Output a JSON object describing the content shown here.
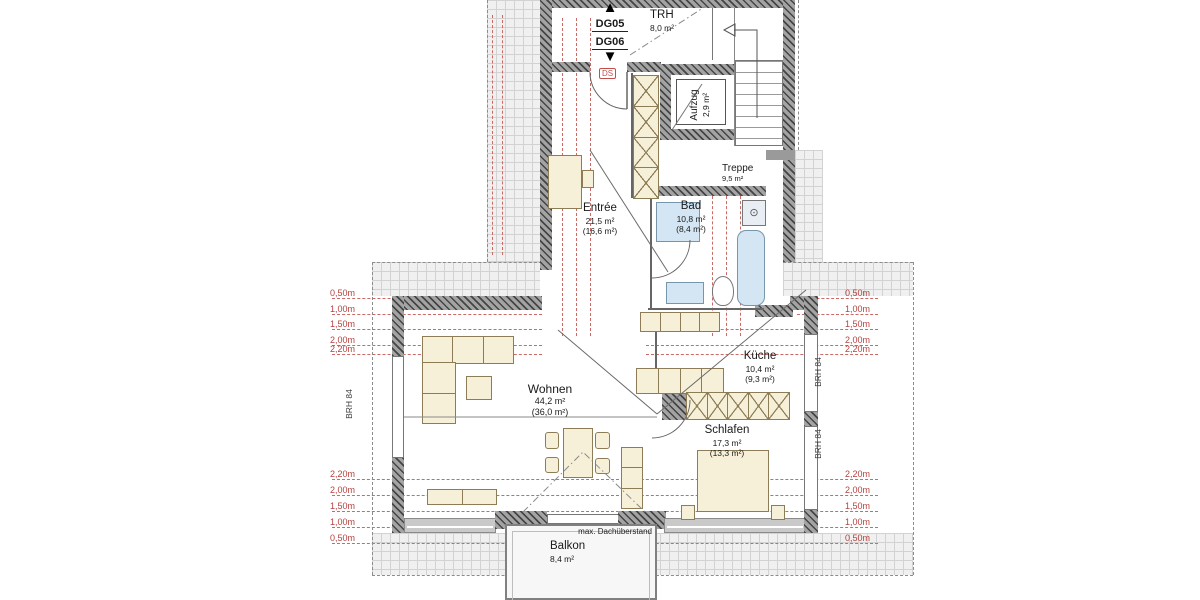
{
  "plan": {
    "icons": {
      "up": "▲",
      "down": "▼"
    },
    "units": [
      {
        "label": "DG05"
      },
      {
        "label": "DG06"
      }
    ],
    "tags": {
      "ds": "DS"
    },
    "rooms": [
      {
        "name": "TRH",
        "area": "8,0 m²",
        "area2": ""
      },
      {
        "name": "Aufzug",
        "area": "2,9 m²",
        "area2": ""
      },
      {
        "name": "Treppe",
        "area": "9,5 m²",
        "area2": ""
      },
      {
        "name": "Bad",
        "area": "10,8 m²",
        "area2": "(8,4 m²)"
      },
      {
        "name": "Entrée",
        "area": "21,5 m²",
        "area2": "(16,6 m²)"
      },
      {
        "name": "Wohnen",
        "area": "44,2 m²",
        "area2": "(36,0 m²)"
      },
      {
        "name": "Küche",
        "area": "10,4 m²",
        "area2": "(9,3 m²)"
      },
      {
        "name": "Schlafen",
        "area": "17,3 m²",
        "area2": "(13,3 m²)"
      },
      {
        "name": "Balkon",
        "area": "8,4 m²",
        "area2": ""
      }
    ],
    "height_lines": {
      "top": [
        "0,50m",
        "1,00m",
        "1,50m",
        "2,00m",
        "2,20m"
      ],
      "bottom": [
        "2,20m",
        "2,00m",
        "1,50m",
        "1,00m",
        "0,50m"
      ]
    },
    "annotations": {
      "brh": "BRH 84",
      "overhang": "max. Dachüberstand"
    },
    "colors": {
      "dash_red": "#c96a66",
      "label_red": "#b5413d",
      "furniture": "#f7f0d8",
      "fixture": "#d4e6f3",
      "wall": "#4a4a4a"
    }
  }
}
